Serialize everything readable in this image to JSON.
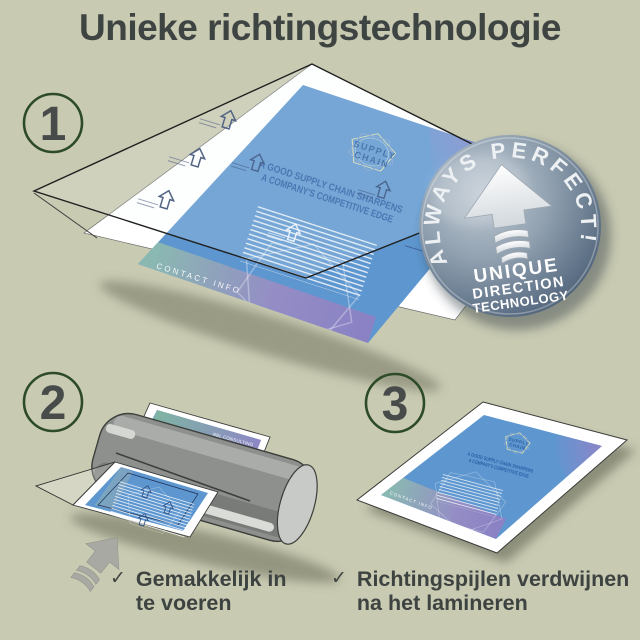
{
  "title": "Unieke richtingstechnologie",
  "steps": [
    {
      "number": "1"
    },
    {
      "number": "2"
    },
    {
      "number": "3"
    }
  ],
  "badge": {
    "arc_text": "ALWAYS PERFECT!",
    "line1": "UNIQUE",
    "line2": "DIRECTION",
    "line3": "TECHNOLOGY"
  },
  "flyer": {
    "brand": "BBL CONSULTING",
    "logo_line1": "SUPPLY",
    "logo_line2": "CHAIN",
    "headline_line1": "A GOOD SUPPLY CHAIN SHARPENS",
    "headline_line2": "A COMPANY'S COMPETITIVE EDGE",
    "footer": "CONTACT INFO"
  },
  "captions": {
    "left": {
      "check": "✓",
      "line1": "Gemakkelijk in",
      "line2": "te voeren"
    },
    "right": {
      "check": "✓",
      "line1": "Richtingspijlen verdwijnen",
      "line2": "na het lamineren"
    }
  },
  "colors": {
    "background": "#c9cab2",
    "heading_text": "#3e4442",
    "step_circle_green": "#2d4b27",
    "step_number_gray": "#474b4a",
    "flyer_blue": "#5e97d0",
    "flyer_accent_blue": "#2b5ea6",
    "badge_slate": "#5f7287",
    "machine_gray": "#8d908d",
    "direction_arrow_gray": "#a8a9a2"
  }
}
